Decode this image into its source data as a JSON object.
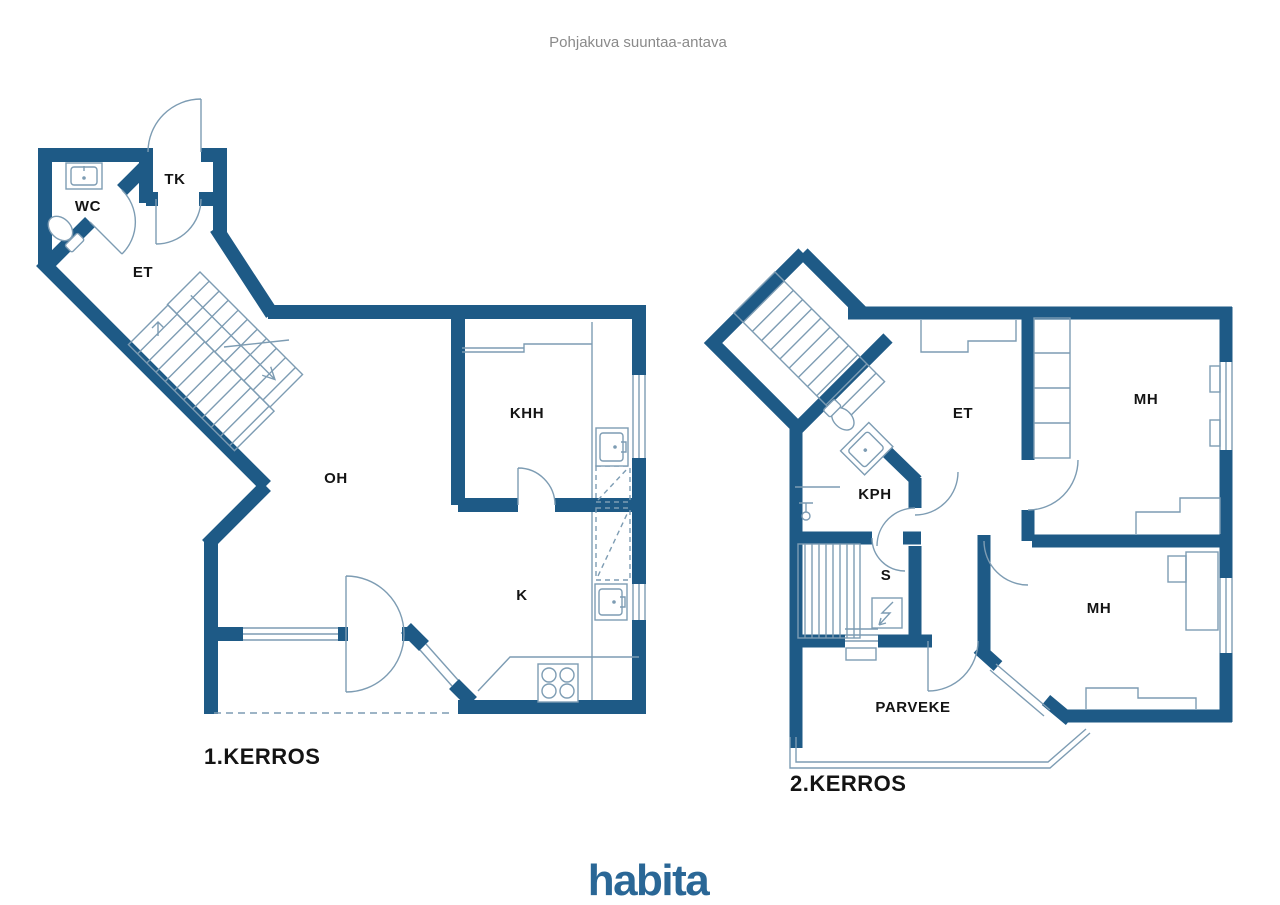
{
  "title": "Pohjakuva suuntaa-antava",
  "logo": "habita",
  "floors": [
    {
      "name": "1.KERROS",
      "rooms": {
        "tk": "TK",
        "wc": "WC",
        "et": "ET",
        "oh": "OH",
        "khh": "KHH",
        "k": "K"
      }
    },
    {
      "name": "2.KERROS",
      "rooms": {
        "et": "ET",
        "mh_top": "MH",
        "kph": "KPH",
        "s": "S",
        "mh_bottom": "MH",
        "parveke": "PARVEKE"
      }
    }
  ],
  "colors": {
    "wall": "#1e5a86",
    "line": "#7d9cb3",
    "label": "#141414",
    "title": "#8a8a8a",
    "logo": "#2a6796",
    "background": "#ffffff"
  }
}
